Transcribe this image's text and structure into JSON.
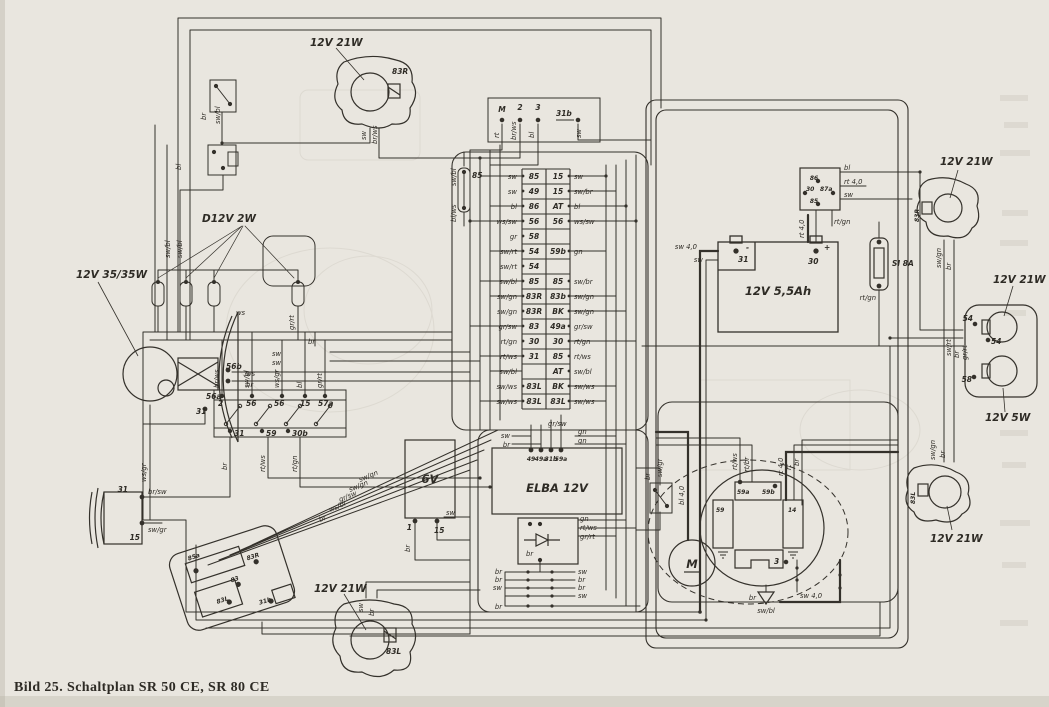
{
  "caption": "Bild 25. Schaltplan SR 50 CE, SR 80 CE",
  "colors": {
    "paper": "#e9e6df",
    "ink": "#2e2b25"
  },
  "lamps": {
    "ind_top": {
      "rating": "12V 21W",
      "socket": "83R",
      "w1": "sw",
      "w2": "br/ws"
    },
    "ind_bottom": {
      "rating": "12V 21W",
      "socket": "83L",
      "w1": "sw",
      "w2": "br"
    },
    "ind_right_top": {
      "rating": "12V 21W",
      "socket": "83R",
      "w1": "sw/gn",
      "w2": "br"
    },
    "ind_right_bottom": {
      "rating": "12V 21W",
      "socket": "83L",
      "w1": "sw/gn",
      "w2": "br"
    },
    "headlamp": {
      "rating": "12V 35/35W",
      "t1": "56b",
      "t2": "56a",
      "t3": "31",
      "w1": "ws",
      "w2": "br",
      "w3": "ws/gr"
    },
    "pilot": {
      "rating": "D12V 2W",
      "w1": "sw/bl",
      "w2": "sw/bl",
      "w3": "ws",
      "w4": "gr/rt"
    },
    "tail": {
      "rating_brake": "12V 21W",
      "rating_tail": "12V 5W",
      "t1": "54",
      "t2": "54",
      "t3": "58",
      "w1": "sw/rt",
      "w2": "br",
      "w3": "gr/rt"
    }
  },
  "switches": {
    "light": {
      "top": [
        "2",
        "56",
        "56",
        "15",
        "57a"
      ],
      "bottom": [
        "31",
        "59",
        "30b"
      ],
      "wt": [
        "br/ws",
        "sw/bl",
        "ws/gr",
        "bl",
        "gr/rt"
      ],
      "wb": [
        "br",
        "rt/ws",
        "rt/gn"
      ],
      "w1": "sw",
      "w2": "sw",
      "w3": "br"
    },
    "bar": {
      "t": [
        "85a",
        "83R",
        "83",
        "83L",
        "31b"
      ],
      "w": [
        "br",
        "ws/bl",
        "gr/sw",
        "sw/gn",
        "sw/gn"
      ]
    },
    "ignition": {
      "t": [
        "M",
        "2",
        "3",
        "31b"
      ],
      "w": [
        "rt",
        "br/ws",
        "bl",
        "sw"
      ]
    },
    "front1": {
      "w1": "br",
      "w2": "sw/bl"
    },
    "front2": {
      "w1": "bl"
    },
    "rear_brake": {
      "w1": "br",
      "w2": "sw/gr"
    }
  },
  "horn": {
    "t1": "31",
    "w1": "br/sw",
    "t2": "15",
    "w2": "sw/gr"
  },
  "power": {
    "battery": {
      "rating": "12V 5,5Ah",
      "tm": "31",
      "tp": "30",
      "plus": "+",
      "minus": "-",
      "w1": "sw 4,0",
      "w2": "sw",
      "w3": "rt 4,0"
    },
    "relay": {
      "t1": "86",
      "t2": "30",
      "t3": "87a",
      "t4": "85",
      "w1": "bl",
      "w2": "rt 4,0",
      "w3": "sw",
      "w4": "rt/gn"
    },
    "fuse": {
      "label": "SI 8A",
      "w1": "rt/gn"
    },
    "coil": {
      "label": "6V",
      "t1": "1",
      "t2": "15",
      "w1": "sw",
      "w2": "br"
    },
    "elba": {
      "label": "ELBA 12V",
      "t": [
        "49",
        "49a",
        "31b",
        "59a"
      ],
      "wl1": "sw",
      "wl2": "br",
      "wr1": "gn",
      "wr2": "gn"
    },
    "rect": {
      "w1": "gn",
      "w2": "rt/ws",
      "w3": "gr/rt",
      "w4": "br"
    },
    "conn": {
      "l": [
        "br",
        "br",
        "sw"
      ],
      "r": [
        "sw",
        "br",
        "br",
        "sw"
      ],
      "b": "br"
    },
    "auxfuse": {
      "t": "85",
      "w1": "sw/bl",
      "w2": "bl/ws"
    }
  },
  "engine": {
    "m": "M",
    "c1": "59a",
    "c2": "59b",
    "c3": "59",
    "c4": "14",
    "t3": "3",
    "w1": "rt/ws",
    "w2": "rt/br",
    "w3": "rt 4,0",
    "w4": "rt",
    "w5": "br",
    "wm": "bl 4,0",
    "g1": "br",
    "g2": "sw/bl",
    "g3": "sw 4,0"
  },
  "strip": {
    "below": "gr/sw",
    "rows": [
      {
        "lw": "sw",
        "lt": "85",
        "rt": "15",
        "rw": "sw"
      },
      {
        "lw": "sw",
        "lt": "49",
        "rt": "15",
        "rw": "sw/br"
      },
      {
        "lw": "bl",
        "lt": "86",
        "rt": "AT",
        "rw": "bl"
      },
      {
        "lw": "ws/sw",
        "lt": "56",
        "rt": "56",
        "rw": "ws/sw"
      },
      {
        "lw": "gr",
        "lt": "58",
        "rt": "",
        "rw": ""
      },
      {
        "lw": "sw/rt",
        "lt": "54",
        "rt": "59b",
        "rw": "gn"
      },
      {
        "lw": "sw/rt",
        "lt": "54",
        "rt": "",
        "rw": ""
      },
      {
        "lw": "sw/bl",
        "lt": "85",
        "rt": "85",
        "rw": "sw/br"
      },
      {
        "lw": "sw/gn",
        "lt": "83R",
        "rt": "83b",
        "rw": "sw/gn"
      },
      {
        "lw": "sw/gn",
        "lt": "83R",
        "rt": "BK",
        "rw": "sw/gn"
      },
      {
        "lw": "gr/sw",
        "lt": "83",
        "rt": "49a",
        "rw": "gr/sw"
      },
      {
        "lw": "rt/gn",
        "lt": "30",
        "rt": "30",
        "rw": "rt/gn"
      },
      {
        "lw": "rt/ws",
        "lt": "31",
        "rt": "85",
        "rw": "rt/ws"
      },
      {
        "lw": "sw/bl",
        "lt": "",
        "rt": "AT",
        "rw": "sw/bl"
      },
      {
        "lw": "sw/ws",
        "lt": "83L",
        "rt": "BK",
        "rw": "sw/ws"
      },
      {
        "lw": "sw/ws",
        "lt": "83L",
        "rt": "83L",
        "rw": "sw/ws"
      }
    ]
  }
}
